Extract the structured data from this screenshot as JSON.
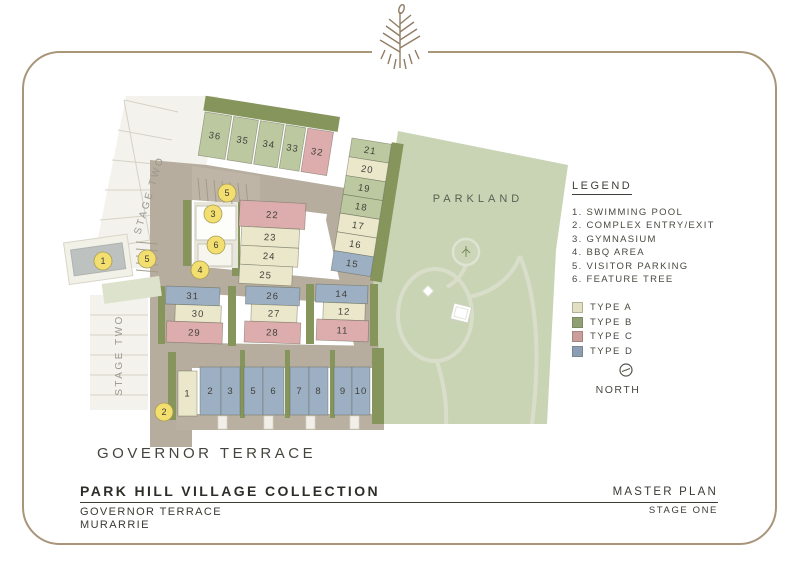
{
  "plan": {
    "labels": {
      "parkland": "PARKLAND",
      "stage_two": "STAGE TWO",
      "street": "GOVERNOR TERRACE"
    },
    "lot_types": {
      "A": "#eae7cb",
      "B": "#bcc9a0",
      "C": "#dcadac",
      "D": "#9cafc3"
    },
    "lot_groups": [
      {
        "name": "top-row",
        "rot": 9,
        "cx": 207,
        "cy": 100,
        "lots": [
          {
            "n": "36",
            "type": "B",
            "x": 207,
            "y": 112,
            "w": 27,
            "h": 44
          },
          {
            "n": "35",
            "type": "B",
            "x": 236,
            "y": 112,
            "w": 25,
            "h": 44
          },
          {
            "n": "34",
            "type": "B",
            "x": 263,
            "y": 112,
            "w": 24,
            "h": 44
          },
          {
            "n": "33",
            "type": "B",
            "x": 289,
            "y": 112,
            "w": 20,
            "h": 44
          },
          {
            "n": "32",
            "type": "C",
            "x": 311,
            "y": 112,
            "w": 26,
            "h": 44
          }
        ]
      },
      {
        "name": "east-column",
        "rot": 9,
        "cx": 352,
        "cy": 138,
        "lots": [
          {
            "n": "21",
            "type": "B",
            "x": 352,
            "y": 138,
            "w": 40,
            "h": 19
          },
          {
            "n": "20",
            "type": "A",
            "x": 352,
            "y": 157,
            "w": 40,
            "h": 19
          },
          {
            "n": "19",
            "type": "B",
            "x": 352,
            "y": 176,
            "w": 40,
            "h": 19
          },
          {
            "n": "18",
            "type": "B",
            "x": 352,
            "y": 195,
            "w": 40,
            "h": 19
          },
          {
            "n": "17",
            "type": "A",
            "x": 352,
            "y": 214,
            "w": 40,
            "h": 19
          },
          {
            "n": "16",
            "type": "A",
            "x": 352,
            "y": 233,
            "w": 40,
            "h": 19
          },
          {
            "n": "15",
            "type": "D",
            "x": 352,
            "y": 252,
            "w": 40,
            "h": 20
          }
        ]
      },
      {
        "name": "centre-block",
        "rot": 3,
        "cx": 238,
        "cy": 202,
        "lots": [
          {
            "n": "22",
            "type": "C",
            "x": 240,
            "y": 200,
            "w": 66,
            "h": 26
          },
          {
            "n": "23",
            "type": "A",
            "x": 243,
            "y": 226,
            "w": 58,
            "h": 19
          },
          {
            "n": "24",
            "type": "A",
            "x": 243,
            "y": 245,
            "w": 58,
            "h": 19
          },
          {
            "n": "25",
            "type": "A",
            "x": 243,
            "y": 264,
            "w": 53,
            "h": 19
          }
        ]
      },
      {
        "name": "mid-block-west",
        "rot": 2,
        "cx": 166,
        "cy": 287,
        "lots": [
          {
            "n": "31",
            "type": "D",
            "x": 166,
            "y": 286,
            "w": 54,
            "h": 18
          },
          {
            "n": "30",
            "type": "A",
            "x": 176,
            "y": 304,
            "w": 46,
            "h": 17
          },
          {
            "n": "29",
            "type": "C",
            "x": 168,
            "y": 321,
            "w": 56,
            "h": 21
          }
        ]
      },
      {
        "name": "mid-block-centre",
        "rot": 2,
        "cx": 246,
        "cy": 287,
        "lots": [
          {
            "n": "26",
            "type": "D",
            "x": 246,
            "y": 286,
            "w": 54,
            "h": 18
          },
          {
            "n": "27",
            "type": "A",
            "x": 252,
            "y": 304,
            "w": 46,
            "h": 17
          },
          {
            "n": "28",
            "type": "C",
            "x": 246,
            "y": 321,
            "w": 56,
            "h": 21
          }
        ]
      },
      {
        "name": "mid-block-east",
        "rot": 2,
        "cx": 316,
        "cy": 285,
        "lots": [
          {
            "n": "14",
            "type": "D",
            "x": 316,
            "y": 284,
            "w": 52,
            "h": 18
          },
          {
            "n": "12",
            "type": "A",
            "x": 324,
            "y": 302,
            "w": 42,
            "h": 17
          },
          {
            "n": "11",
            "type": "C",
            "x": 318,
            "y": 319,
            "w": 52,
            "h": 21
          }
        ]
      },
      {
        "name": "south-row",
        "rot": 0,
        "cx": 0,
        "cy": 0,
        "lots": [
          {
            "n": "1",
            "type": "A",
            "x": 178,
            "y": 371,
            "w": 19,
            "h": 45
          },
          {
            "n": "2",
            "type": "D",
            "x": 200,
            "y": 367,
            "w": 21,
            "h": 48
          },
          {
            "n": "3",
            "type": "D",
            "x": 221,
            "y": 367,
            "w": 19,
            "h": 48
          },
          {
            "n": "5",
            "type": "D",
            "x": 244,
            "y": 367,
            "w": 19,
            "h": 48
          },
          {
            "n": "6",
            "type": "D",
            "x": 263,
            "y": 367,
            "w": 21,
            "h": 48
          },
          {
            "n": "7",
            "type": "D",
            "x": 290,
            "y": 367,
            "w": 19,
            "h": 48
          },
          {
            "n": "8",
            "type": "D",
            "x": 309,
            "y": 367,
            "w": 19,
            "h": 48
          },
          {
            "n": "9",
            "type": "D",
            "x": 334,
            "y": 367,
            "w": 18,
            "h": 48
          },
          {
            "n": "10",
            "type": "D",
            "x": 352,
            "y": 367,
            "w": 18,
            "h": 48
          }
        ]
      }
    ],
    "markers": [
      {
        "n": "1",
        "name": "swimming-pool",
        "x": 103,
        "y": 261
      },
      {
        "n": "5",
        "name": "visitor-parking",
        "x": 147,
        "y": 259
      },
      {
        "n": "2",
        "name": "complex-entry-exit",
        "x": 164,
        "y": 412
      },
      {
        "n": "4",
        "name": "bbq-area",
        "x": 200,
        "y": 270
      },
      {
        "n": "6",
        "name": "feature-tree",
        "x": 216,
        "y": 245
      },
      {
        "n": "3",
        "name": "gymnasium",
        "x": 213,
        "y": 214
      },
      {
        "n": "5",
        "name": "visitor-parking",
        "x": 227,
        "y": 193
      }
    ]
  },
  "legend": {
    "title": "LEGEND",
    "items": [
      "1. SWIMMING POOL",
      "2. COMPLEX ENTRY/EXIT",
      "3. GYMNASIUM",
      "4. BBQ AREA",
      "5. VISITOR PARKING",
      "6. FEATURE TREE"
    ],
    "types": [
      {
        "label": "TYPE A",
        "color": "#e2e0c2"
      },
      {
        "label": "TYPE B",
        "color": "#8fa072"
      },
      {
        "label": "TYPE C",
        "color": "#cb9e9d"
      },
      {
        "label": "TYPE D",
        "color": "#8c9eb3"
      }
    ]
  },
  "north": {
    "label": "NORTH"
  },
  "title_block": {
    "title": "PARK HILL VILLAGE COLLECTION",
    "address_line1": "GOVERNOR TERRACE",
    "address_line2": "MURARRIE",
    "plan_label": "MASTER PLAN",
    "stage_label": "STAGE ONE"
  }
}
